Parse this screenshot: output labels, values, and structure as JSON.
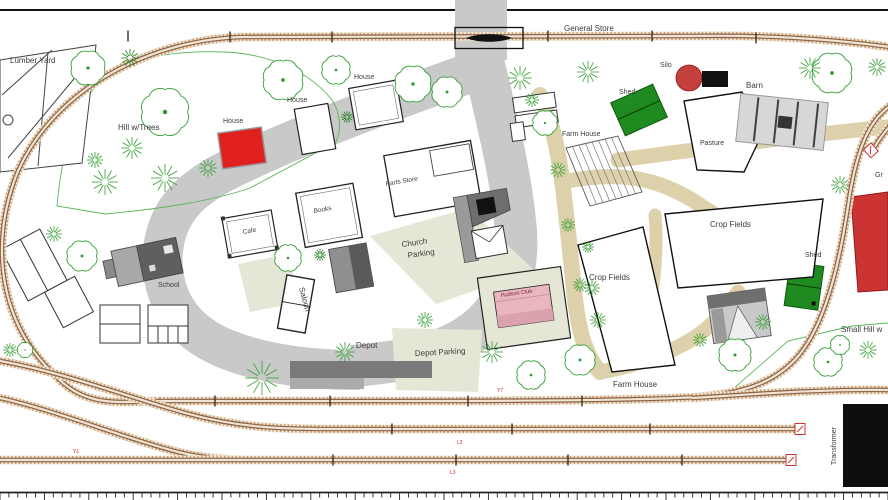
{
  "plan_labels": {
    "lumber_yard": "Lumber Yard",
    "hill_trees": "Hill w/Trees",
    "house_red": "House",
    "house_1": "House",
    "house_2": "House",
    "general_store": "General Store",
    "silo": "Silo",
    "shed_top": "Shed",
    "barn": "Barn",
    "pasture": "Pasture",
    "farm_house_top": "Farm House",
    "parts_store": "Parts Store",
    "books": "Books",
    "cafe": "Cafe",
    "saloon": "Saloon",
    "church_parking_line1": "Church",
    "church_parking_line2": "Parking",
    "school": "School",
    "crop_fields_left": "Crop Fields",
    "crop_fields_right": "Crop Fields",
    "shed_right": "Shed",
    "small_hill": "Small Hill w",
    "grain_clipped": "Gr",
    "depot": "Depot",
    "depot_parking": "Depot Parking",
    "farm_house_bottom": "Farm House",
    "hudson_club": "Hudson Club",
    "transformer": "Transformer"
  },
  "track_markers": {
    "y1": "Y1",
    "y7": "Y7",
    "l2": "L2",
    "l3": "L3"
  },
  "colors": {
    "track_ties": "#c89b6e",
    "rail": "#8a6248",
    "road": "#c9c9c9",
    "parking_lot": "#e6e6d6",
    "farm_lane": "#ddd1ab",
    "tree_green": "#2f9e2f",
    "shed_green": "#1f8a1f",
    "accent_red": "#e01f1f",
    "pink_building": "#e9b6bf",
    "marker_red": "#cc2222"
  }
}
